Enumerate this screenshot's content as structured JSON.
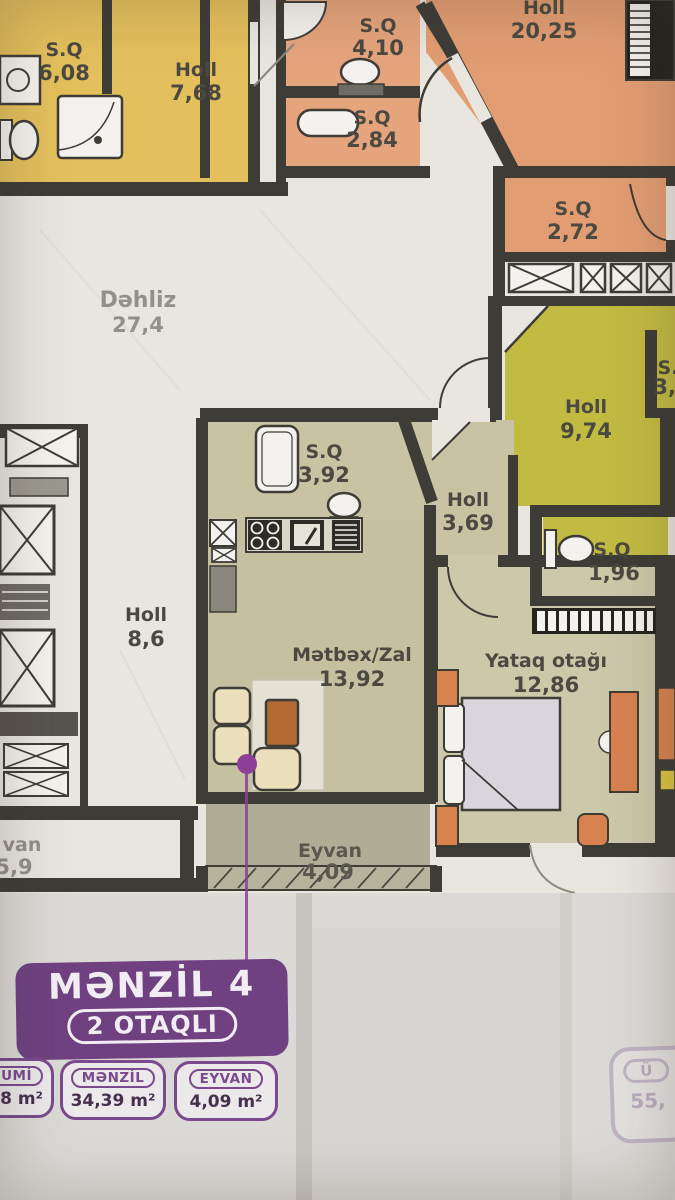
{
  "plan": {
    "rooms": [
      {
        "id": "sq-608",
        "name": "S.Q",
        "area": "6,08"
      },
      {
        "id": "holl-768",
        "name": "Holl",
        "area": "7,68"
      },
      {
        "id": "sq-410",
        "name": "S.Q",
        "area": "4,10"
      },
      {
        "id": "sq-284",
        "name": "S.Q",
        "area": "2,84"
      },
      {
        "id": "holl-2025",
        "name": "Holl",
        "area": "20,25"
      },
      {
        "id": "sq-272",
        "name": "S.Q",
        "area": "2,72"
      },
      {
        "id": "dehliz",
        "name": "Dəhliz",
        "area": "27,4"
      },
      {
        "id": "holl-974",
        "name": "Holl",
        "area": "9,74"
      },
      {
        "id": "sq-37",
        "name": "S.",
        "area": "3,7"
      },
      {
        "id": "sq-392",
        "name": "S.Q",
        "area": "3,92"
      },
      {
        "id": "holl-369",
        "name": "Holl",
        "area": "3,69"
      },
      {
        "id": "sq-196",
        "name": "S.Q",
        "area": "1,96"
      },
      {
        "id": "holl-86",
        "name": "Holl",
        "area": "8,6"
      },
      {
        "id": "metbex-zal",
        "name": "Mətbəx/Zal",
        "area": "13,92"
      },
      {
        "id": "yataq-otagi",
        "name": "Yataq otağı",
        "area": "12,86"
      },
      {
        "id": "eyvan-409",
        "name": "Eyvan",
        "area": "4,09"
      },
      {
        "id": "eyvan-59",
        "name": "van",
        "area": "5,9"
      }
    ]
  },
  "apartment_card": {
    "title": "MƏNZİL 4",
    "type_label": "2 OTAQLI",
    "stats": [
      {
        "label": "UMİ",
        "value": "8 m²"
      },
      {
        "label": "MƏNZİL",
        "value": "34,39 m²"
      },
      {
        "label": "EYVAN",
        "value": "4,09 m²"
      }
    ]
  },
  "neighbor_card": {
    "label": "Ü",
    "value": "55,"
  },
  "colors": {
    "wall": "#3e3c37",
    "marble": "#e9e6e0",
    "room_yellow": "#e4c05c",
    "room_salmon": "#e5a47c",
    "room_orange": "#e29d72",
    "room_olive": "#c2bb42",
    "room_beige": "#c8c4a3",
    "room_bedroom": "#ccc8aa",
    "room_balcony": "#b0ad96",
    "badge_purple": "#6f4181",
    "marker_purple": "#8d3f98",
    "furniture_orange": "#d8824f",
    "table_brown": "#b06a32"
  }
}
